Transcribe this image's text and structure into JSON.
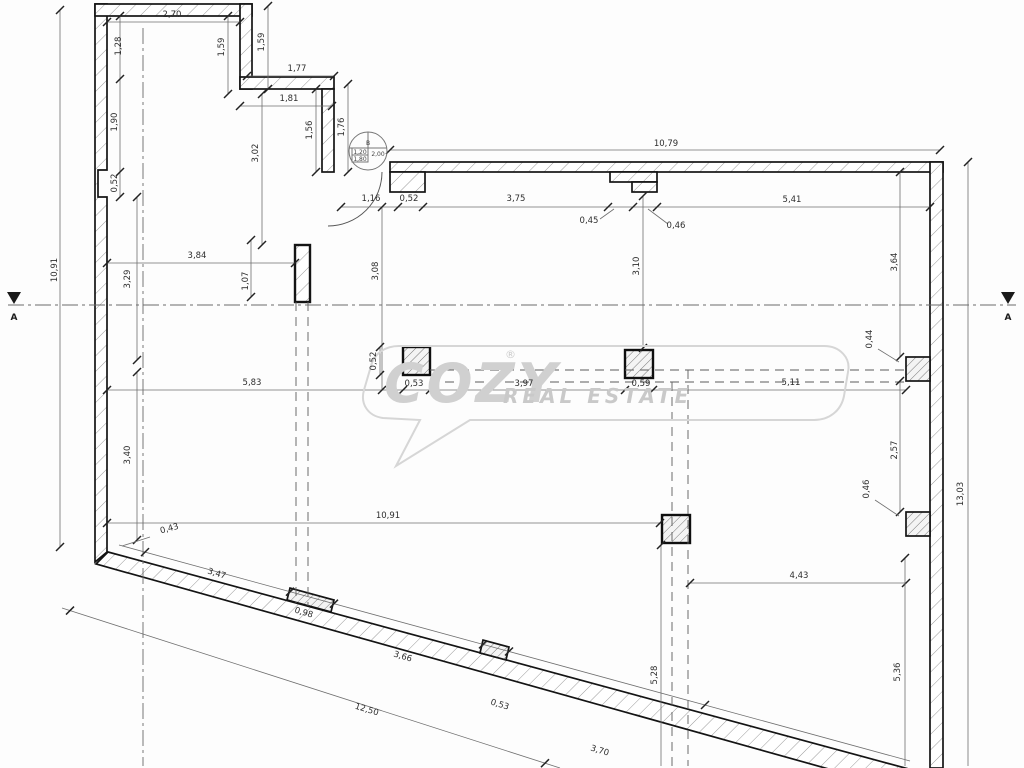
{
  "drawing": {
    "type": "architectural-floor-plan",
    "watermark": {
      "brand": "COZY",
      "reg": "®",
      "tagline": "REAL ESTATE"
    },
    "section_markers": [
      {
        "label": "A"
      },
      {
        "label": "A"
      }
    ],
    "door_tag": {
      "code": "B",
      "width": "1,20",
      "height": "1,80",
      "sill": "2,00"
    },
    "dimensions": [
      {
        "label": "2,70",
        "x": 172,
        "y": 17,
        "rot": 0
      },
      {
        "label": "1,28",
        "x": 121,
        "y": 46,
        "rot": -90
      },
      {
        "label": "1,59",
        "x": 224,
        "y": 47,
        "rot": -90
      },
      {
        "label": "1,59",
        "x": 264,
        "y": 42,
        "rot": -90
      },
      {
        "label": "1,77",
        "x": 297,
        "y": 71,
        "rot": 0
      },
      {
        "label": "1,81",
        "x": 289,
        "y": 101,
        "rot": 0
      },
      {
        "label": "1,90",
        "x": 117,
        "y": 122,
        "rot": -90
      },
      {
        "label": "1,56",
        "x": 312,
        "y": 130,
        "rot": -90
      },
      {
        "label": "1,76",
        "x": 344,
        "y": 127,
        "rot": -90
      },
      {
        "label": "0,52",
        "x": 117,
        "y": 183,
        "rot": -90
      },
      {
        "label": "3,02",
        "x": 258,
        "y": 153,
        "rot": -90
      },
      {
        "label": "1,16",
        "x": 371,
        "y": 201,
        "rot": 0
      },
      {
        "label": "0,52",
        "x": 409,
        "y": 201,
        "rot": 0
      },
      {
        "label": "3,75",
        "x": 516,
        "y": 201,
        "rot": 0
      },
      {
        "label": "0,45",
        "x": 589,
        "y": 223,
        "rot": 0
      },
      {
        "label": "0,46",
        "x": 676,
        "y": 228,
        "rot": 0
      },
      {
        "label": "10,79",
        "x": 666,
        "y": 146,
        "rot": 0
      },
      {
        "label": "5,41",
        "x": 792,
        "y": 202,
        "rot": 0
      },
      {
        "label": "3,84",
        "x": 197,
        "y": 258,
        "rot": 0
      },
      {
        "label": "1,07",
        "x": 248,
        "y": 281,
        "rot": -90
      },
      {
        "label": "3,29",
        "x": 130,
        "y": 279,
        "rot": -90
      },
      {
        "label": "10,91",
        "x": 57,
        "y": 270,
        "rot": -90
      },
      {
        "label": "3,08",
        "x": 378,
        "y": 271,
        "rot": -90
      },
      {
        "label": "3,10",
        "x": 639,
        "y": 266,
        "rot": -90
      },
      {
        "label": "3,64",
        "x": 897,
        "y": 262,
        "rot": -90
      },
      {
        "label": "0,44",
        "x": 872,
        "y": 339,
        "rot": -90
      },
      {
        "label": "5,83",
        "x": 252,
        "y": 385,
        "rot": 0
      },
      {
        "label": "0,52",
        "x": 376,
        "y": 361,
        "rot": -90
      },
      {
        "label": "0,53",
        "x": 414,
        "y": 386,
        "rot": 0
      },
      {
        "label": "3,97",
        "x": 524,
        "y": 386,
        "rot": 0
      },
      {
        "label": "0,59",
        "x": 641,
        "y": 386,
        "rot": 0
      },
      {
        "label": "5,11",
        "x": 791,
        "y": 385,
        "rot": 0
      },
      {
        "label": "2,57",
        "x": 897,
        "y": 450,
        "rot": -90
      },
      {
        "label": "0,46",
        "x": 869,
        "y": 489,
        "rot": -90
      },
      {
        "label": "13,03",
        "x": 963,
        "y": 494,
        "rot": -90
      },
      {
        "label": "3,40",
        "x": 130,
        "y": 455,
        "rot": -90
      },
      {
        "label": "0,43",
        "x": 170,
        "y": 531,
        "rot": -15
      },
      {
        "label": "10,91",
        "x": 388,
        "y": 518,
        "rot": 0
      },
      {
        "label": "3,47",
        "x": 216,
        "y": 576,
        "rot": 17
      },
      {
        "label": "0,98",
        "x": 303,
        "y": 615,
        "rot": 17
      },
      {
        "label": "3,66",
        "x": 402,
        "y": 659,
        "rot": 17
      },
      {
        "label": "0,53",
        "x": 499,
        "y": 707,
        "rot": 17
      },
      {
        "label": "3,70",
        "x": 599,
        "y": 753,
        "rot": 17
      },
      {
        "label": "12,50",
        "x": 366,
        "y": 712,
        "rot": 17
      },
      {
        "label": "4,43",
        "x": 799,
        "y": 578,
        "rot": 0
      },
      {
        "label": "5,28",
        "x": 657,
        "y": 675,
        "rot": -90
      },
      {
        "label": "5,36",
        "x": 900,
        "y": 672,
        "rot": -90
      }
    ]
  }
}
